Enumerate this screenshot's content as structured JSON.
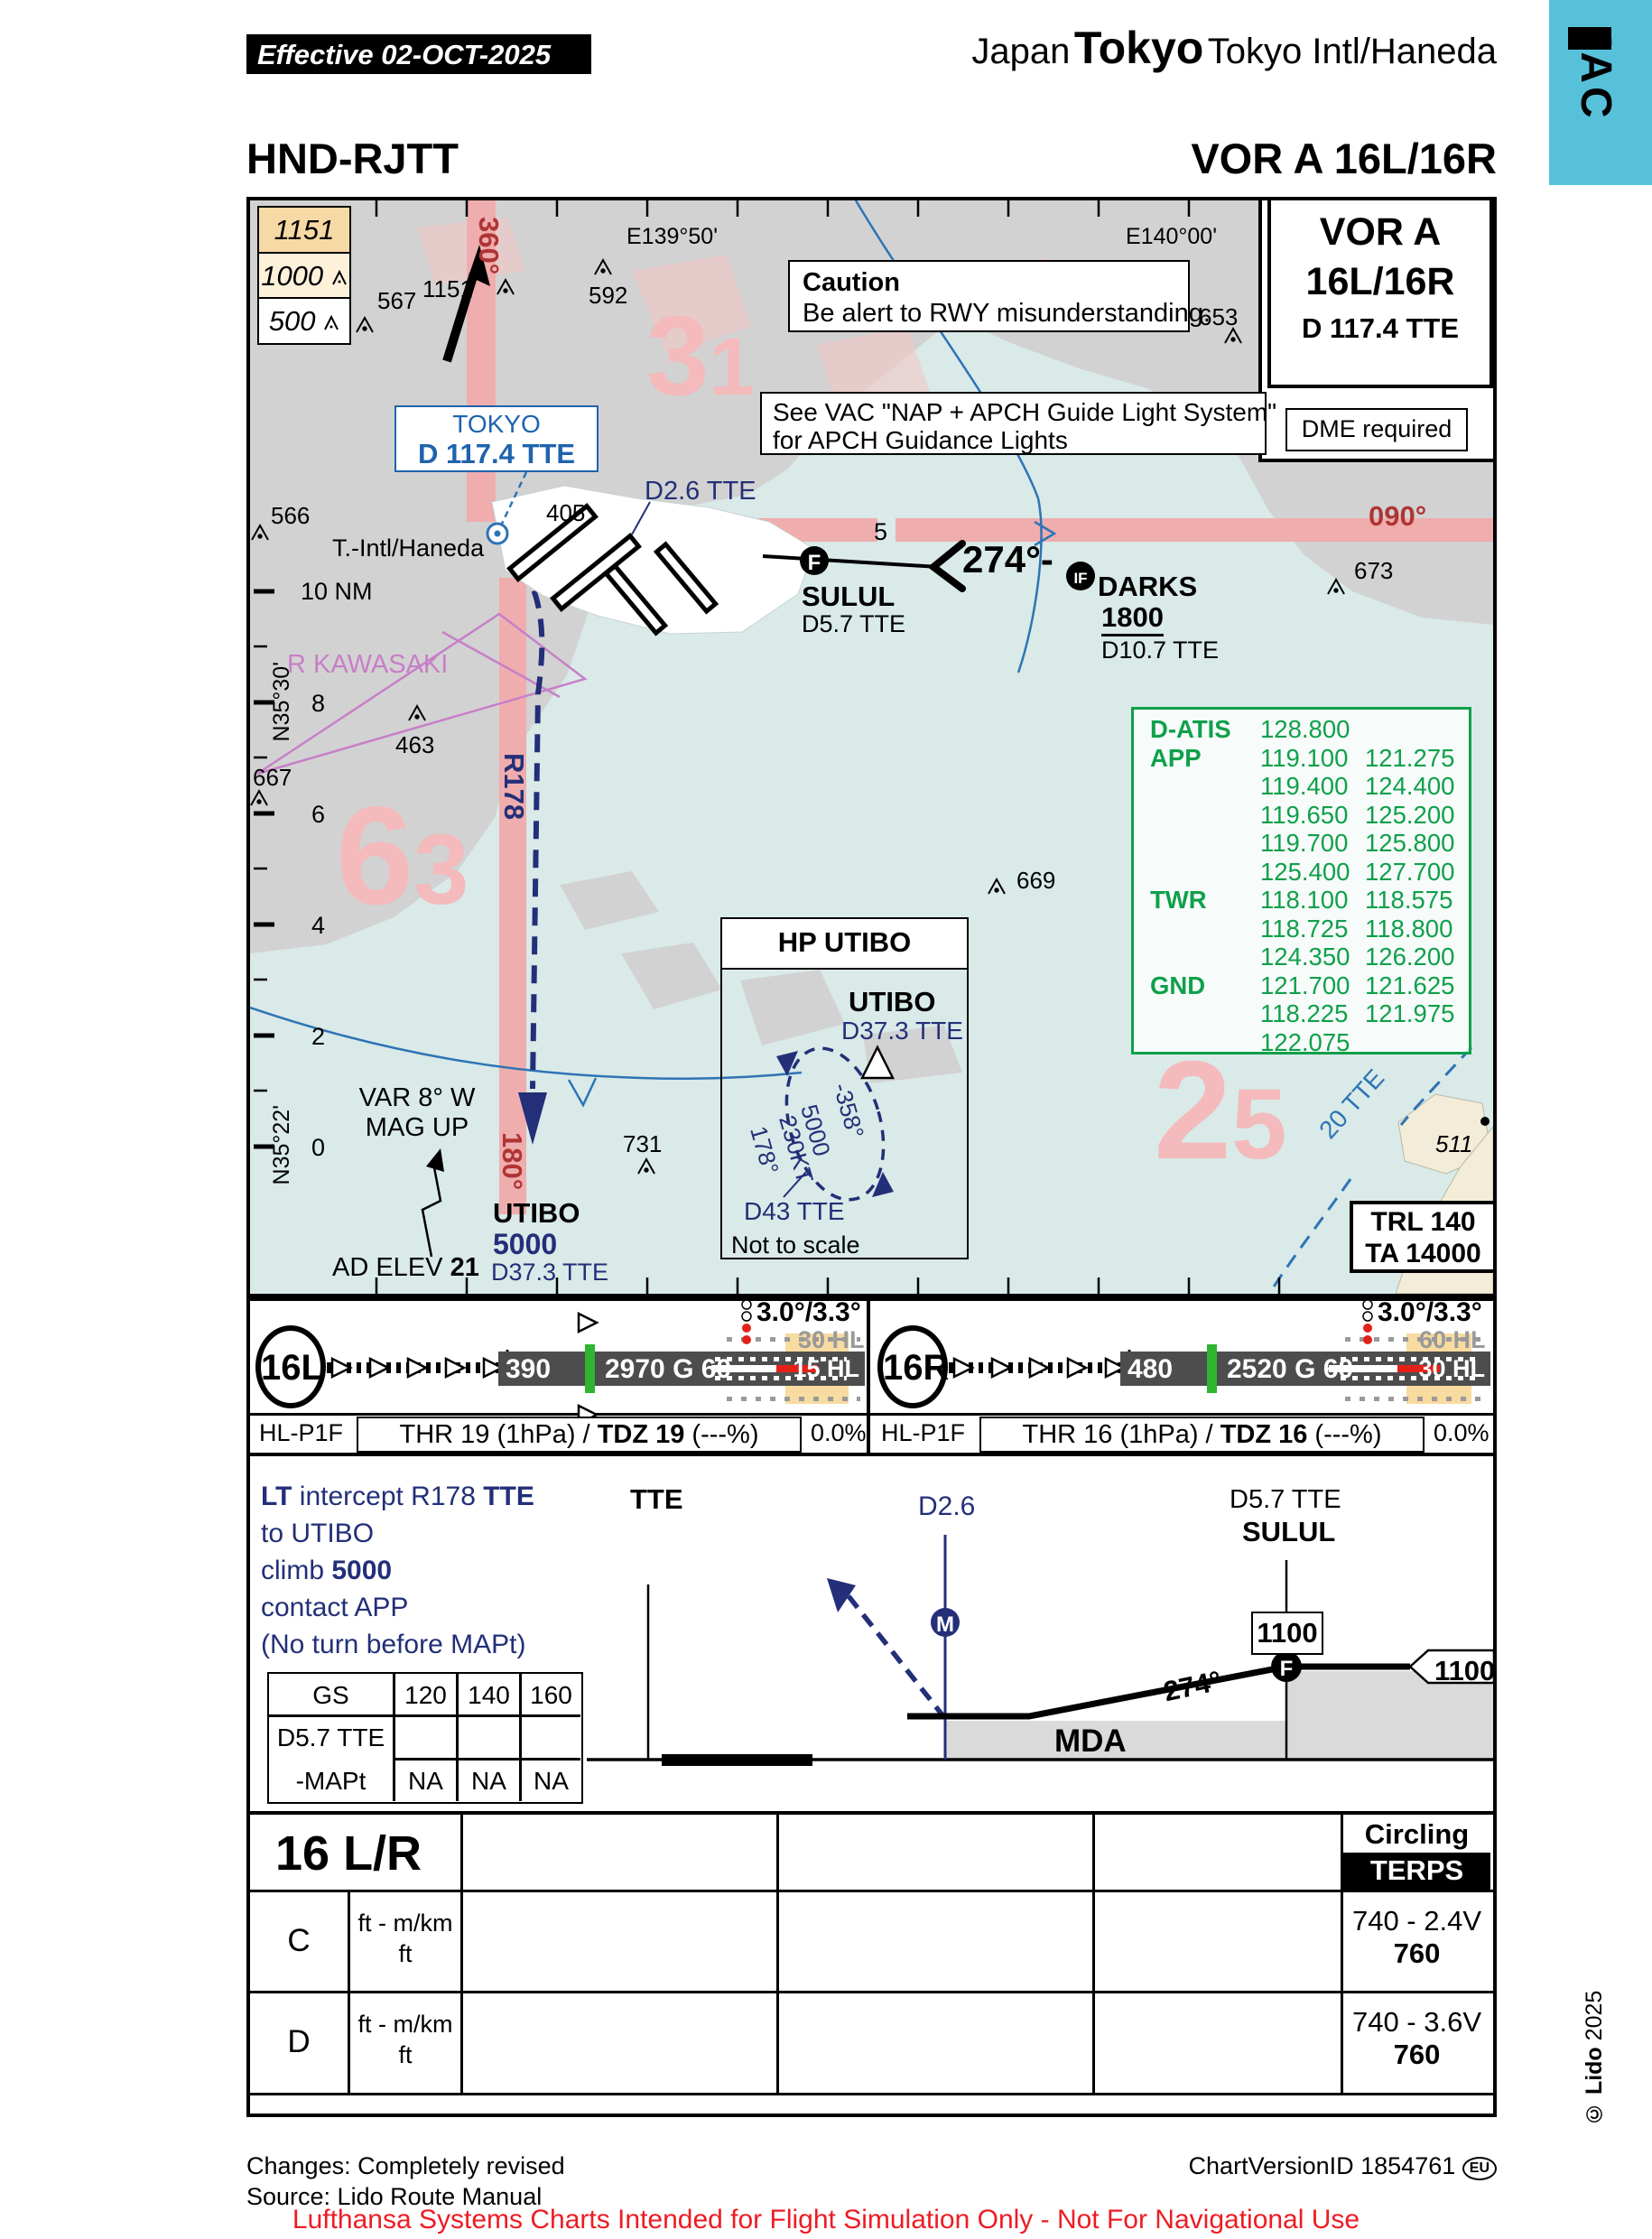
{
  "header": {
    "effective": "Effective  02-OCT-2025",
    "country": "Japan",
    "city": "Tokyo",
    "airport": " Tokyo Intl/Haneda",
    "side_tab": "IAC",
    "icao": "HND-RJTT",
    "procedure": "VOR A 16L/16R"
  },
  "title_box": {
    "l1": "VOR A",
    "l2": "16L/16R",
    "l3": "D 117.4 TTE",
    "dme": "DME required"
  },
  "caution": {
    "title": "Caution",
    "body": "Be alert to RWY misunderstanding."
  },
  "vac": {
    "l1": "See VAC \"NAP + APCH Guide Light System\"",
    "l2": "for APCH Guidance Lights"
  },
  "legend": {
    "b1": "1151",
    "b2": "1000",
    "b3": "500"
  },
  "map": {
    "lon1": "E139°50'",
    "lon2": "E140°00'",
    "lat1": "N35°30'",
    "lat2": "N35°22'",
    "nm": [
      "10 NM",
      "8",
      "6",
      "4",
      "2",
      "0"
    ],
    "vor_name": "TOKYO",
    "vor_freq": "D 117.4 TTE",
    "airport": "T.-Intl/Haneda",
    "r_north": "360°",
    "r_east": "090°",
    "r_south": "180°",
    "r178": "R178",
    "d26": "D2.6 TTE",
    "seg5": "5",
    "course": "274°-",
    "sulul": "SULUL",
    "sulul_d": "D5.7 TTE",
    "f": "F",
    "if": "IF",
    "darks": "DARKS",
    "darks_alt": "1800",
    "darks_d": "D10.7 TTE",
    "utibo": "UTIBO",
    "utibo_alt": "5000",
    "utibo_d": "D37.3 TTE",
    "restricted": "R KAWASAKI",
    "arc": "20 TTE",
    "var1": "VAR 8° W",
    "var2": "MAG UP",
    "adelev": "AD ELEV ",
    "adelev_v": "21",
    "trl": "TRL 140",
    "ta": "TA 14000",
    "mora1a": "3",
    "mora1b": "1",
    "mora2a": "6",
    "mora2b": "3",
    "mora3a": "2",
    "mora3b": "5",
    "spots": [
      "1151",
      "567",
      "592",
      "566",
      "653",
      "673",
      "463",
      "667",
      "669",
      "731",
      "405",
      "511"
    ]
  },
  "hold": {
    "title": "HP UTIBO",
    "fix": "UTIBO",
    "fix_d": "D37.3 TTE",
    "inb": "-358°",
    "alt": "5000",
    "spd": "230KT",
    "outb": "178°",
    "lim": "D43 TTE",
    "note": "Not to scale"
  },
  "comms": {
    "rows": [
      [
        "D-ATIS",
        "128.800",
        ""
      ],
      [
        "APP",
        "119.100",
        "121.275"
      ],
      [
        "",
        "119.400",
        "124.400"
      ],
      [
        "",
        "119.650",
        "125.200"
      ],
      [
        "",
        "119.700",
        "125.800"
      ],
      [
        "",
        "125.400",
        "127.700"
      ],
      [
        "TWR",
        "118.100",
        "118.575"
      ],
      [
        "",
        "118.725",
        "118.800"
      ],
      [
        "",
        "124.350",
        "126.200"
      ],
      [
        "GND",
        "121.700",
        "121.625"
      ],
      [
        "",
        "118.225",
        "121.975"
      ],
      [
        "",
        "122.075",
        ""
      ]
    ]
  },
  "rwy16l": {
    "id": "16L",
    "elev": "390",
    "dim": "2970 G 60",
    "hl_above": "30 HL",
    "hl_in": "15 HL",
    "papi": "3.0°/3.3°",
    "hl": "HL-P1F",
    "thr_a": "THR 19 (1hPa) / ",
    "thr_b": "TDZ 19",
    "thr_c": " (---%)",
    "slope": "0.0%"
  },
  "rwy16r": {
    "id": "16R",
    "elev": "480",
    "dim": "2520 G 60",
    "hl_above": "60 HL",
    "hl_in": "30 HL",
    "papi": "3.0°/3.3°",
    "hl": "HL-P1F",
    "thr_a": "THR 16 (1hPa) / ",
    "thr_b": "TDZ 16",
    "thr_c": " (---%)",
    "slope": "0.0%"
  },
  "profile": {
    "m1a": "LT",
    "m1b": " intercept R178 ",
    "m1c": "TTE",
    "m2": "to UTIBO",
    "m3a": "climb ",
    "m3b": "5000",
    "m4": "contact APP",
    "m5": "(No turn before MAPt)",
    "tte": "TTE",
    "d26": "D2.6",
    "m": "M",
    "f": "F",
    "sulul_d": "D5.7 TTE",
    "sulul": "SULUL",
    "alt1": "1100",
    "alt2": "1100",
    "crs": "274°",
    "mda": "MDA",
    "gs": {
      "h0": "GS",
      "h1": "120",
      "h2": "140",
      "h3": "160",
      "l1": "D5.7 TTE",
      "l2": "-MAPt",
      "v0": "NA",
      "v1": "NA",
      "v2": "NA"
    }
  },
  "minima": {
    "rwy": "16 L/R",
    "circling": "Circling",
    "terps": "TERPS",
    "catC": {
      "cat": "C",
      "u1": "ft - m/km",
      "u2": "ft",
      "v1": "740 - 2.4V",
      "v2": "760"
    },
    "catD": {
      "cat": "D",
      "u1": "ft - m/km",
      "u2": "ft",
      "v1": "740 - 3.6V",
      "v2": "760"
    }
  },
  "footer": {
    "changes": "Changes: Completely revised",
    "source": "Source: Lido Route Manual",
    "version": "ChartVersionID 1854761",
    "eu": "EU",
    "cop1": "© Lido",
    "cop2": " 2025",
    "disclaimer": "Lufthansa Systems Charts Intended for Flight Simulation Only - Not For Navigational Use"
  }
}
